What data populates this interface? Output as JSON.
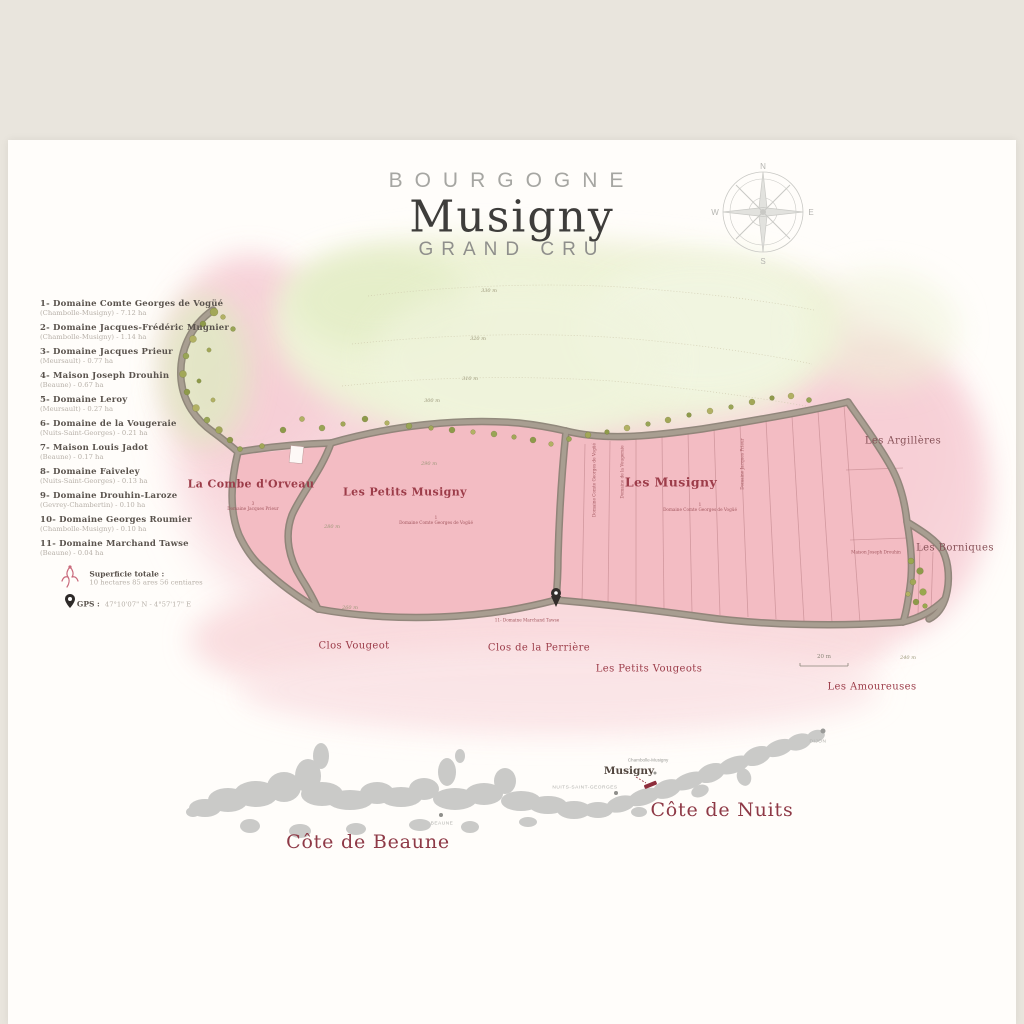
{
  "poster": {
    "region": "BOURGOGNE",
    "title": "Musigny",
    "subtitle": "GRAND CRU"
  },
  "compass": {
    "n": "N",
    "e": "E",
    "s": "S",
    "w": "W"
  },
  "legend": {
    "domaines": [
      {
        "label": "1- Domaine Comte Georges de Vogüé",
        "detail": "(Chambolle-Musigny) - 7.12 ha"
      },
      {
        "label": "2- Domaine Jacques-Frédéric Mugnier",
        "detail": "(Chambolle-Musigny) - 1.14 ha"
      },
      {
        "label": "3- Domaine Jacques Prieur",
        "detail": "(Meursault) - 0.77 ha"
      },
      {
        "label": "4- Maison Joseph Drouhin",
        "detail": "(Beaune) - 0.67 ha"
      },
      {
        "label": "5- Domaine Leroy",
        "detail": "(Meursault) - 0.27 ha"
      },
      {
        "label": "6- Domaine de la Vougeraie",
        "detail": "(Nuits-Saint-Georges) - 0.21 ha"
      },
      {
        "label": "7- Maison Louis Jadot",
        "detail": "(Beaune) - 0.17 ha"
      },
      {
        "label": "8- Domaine Faiveley",
        "detail": "(Nuits-Saint-Georges) - 0.13 ha"
      },
      {
        "label": "9- Domaine Drouhin-Laroze",
        "detail": "(Gevrey-Chambertin) - 0.10 ha"
      },
      {
        "label": "10- Domaine Georges Roumier",
        "detail": "(Chambolle-Musigny) - 0.10 ha"
      },
      {
        "label": "11- Domaine Marchand Tawse",
        "detail": "(Beaune) - 0.04 ha"
      }
    ],
    "superficie_label": "Superficie totale :",
    "superficie_value": "10 hectares 85 ares 56 centiares",
    "gps_label": "GPS :",
    "gps_value": "47°10'07\" N - 4°57'17\" E"
  },
  "map": {
    "labels": {
      "combe": "La Combe d'Orveau",
      "petits_musigny": "Les Petits Musigny",
      "musigny": "Les Musigny",
      "argilleres": "Les Argillères",
      "borniques": "Les Borniques",
      "clos_vougeot": "Clos Vougeot",
      "clos_perriere": "Clos de la Perrière",
      "petits_vougeots": "Les Petits Vougeots",
      "amoureuses": "Les Amoureuses"
    },
    "elevations": [
      "330 m",
      "320 m",
      "310 m",
      "300 m",
      "290 m",
      "280 m",
      "260 m",
      "240 m"
    ],
    "scale": "20 m",
    "parcel_owners": {
      "combe_num": "3",
      "combe": "Domaine Jacques Prieur",
      "petits_num": "1",
      "petits": "Domaine Comte Georges de Vogüé",
      "center_num": "1",
      "center": "Domaine Comte Georges de Vogüé",
      "v1": "Domaine Comte Georges de Vogüé",
      "v2": "Domaine de la Vougeraie",
      "v3": "Domaine Jacques Prieur",
      "right": "Maison Joseph Drouhin",
      "marchand": "11- Domaine Marchand Tawse"
    }
  },
  "inset": {
    "cote_de_beaune": "Côte de Beaune",
    "cote_de_nuits": "Côte de Nuits",
    "beaune": "BEAUNE",
    "nuits_saint_georges": "NUITS-SAINT-GEORGES",
    "dijon": "DIJON",
    "chambolle_musigny": "Chambolle-Musigny",
    "musigny": "Musigny"
  },
  "colors": {
    "background": "#e9e5dd",
    "poster": "#fffdfa",
    "vineyard_pink": "#f3bcc3",
    "hillside_green": "#eef3d7",
    "label_red": "#9c3c49",
    "cote_red": "#8e3946",
    "road": "#9a9084",
    "inset_gray": "#cacac8"
  }
}
